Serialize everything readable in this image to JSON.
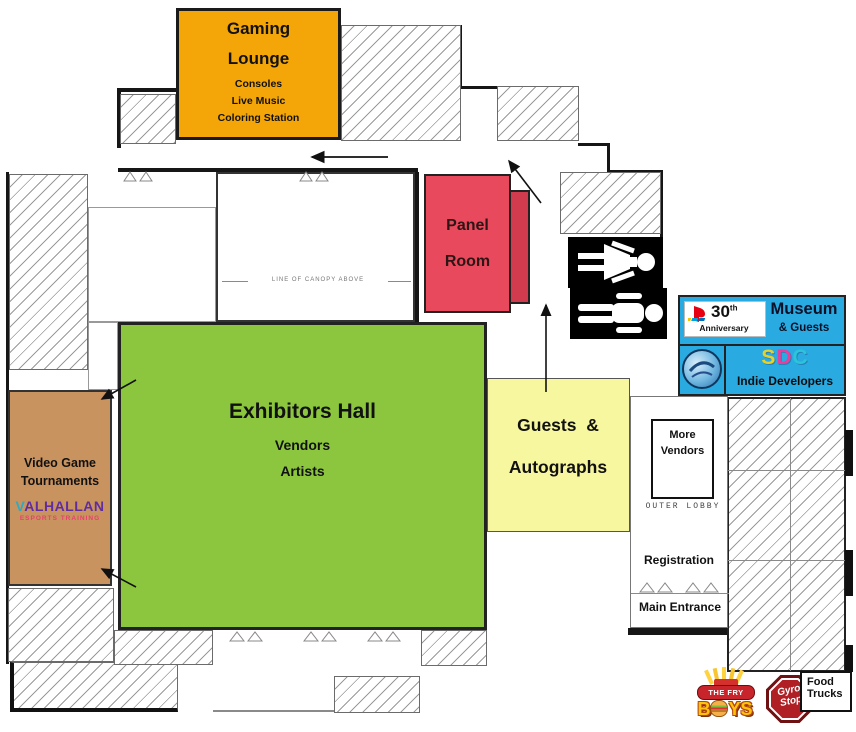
{
  "colors": {
    "gaming_lounge": "#F4A608",
    "panel_room": "#E8495C",
    "panel_room_shadow": "#D23B4E",
    "exhibitors_hall": "#8CC63E",
    "guests_autographs": "#F7F7A0",
    "video_game_tournaments": "#C9935F",
    "museum_blue": "#29ABE2",
    "restroom_black": "#000000"
  },
  "rooms": {
    "gaming_lounge": {
      "title_line1": "Gaming",
      "title_line2": "Lounge",
      "features": {
        "f1": "Consoles",
        "f2": "Live Music",
        "f3": "Coloring Station"
      }
    },
    "panel_room": {
      "line1": "Panel",
      "line2": "Room"
    },
    "exhibitors_hall": {
      "title": "Exhibitors Hall",
      "f1": "Vendors",
      "f2": "Artists"
    },
    "guests_autographs": {
      "line1": "Guests  &",
      "line2": "Autographs"
    },
    "video_game_tournaments": {
      "line1": "Video Game",
      "line2": "Tournaments"
    },
    "more_vendors": {
      "line1": "More",
      "line2": "Vendors"
    },
    "registration_label": "Registration",
    "main_entrance_label": "Main Entrance",
    "outer_lobby_label": "OUTER LOBBY",
    "canopy_note": "LINE OF CANOPY ABOVE"
  },
  "logos": {
    "valhallan": {
      "initial": "V",
      "rest": "ALHALLAN",
      "tagline": "ESPORTS TRAINING"
    },
    "playstation": {
      "number": "30",
      "ordinal": "th",
      "label": "Anniversary"
    },
    "museum": {
      "title": "Museum",
      "subtitle": "& Guests"
    },
    "sdc": {
      "s": "S",
      "d": "D",
      "c": "C",
      "label": "Indie Developers"
    },
    "fry_boys": {
      "banner": "THE FRY",
      "word_pre": "B",
      "word_post": "YS"
    },
    "gyro_stop": {
      "line1": "Gyro",
      "line2": "Stop"
    },
    "food_trucks": {
      "line1": "Food",
      "line2": "Trucks"
    }
  },
  "icons": {
    "restrooms_women": "women-restroom-icon",
    "restrooms_men": "men-restroom-icon",
    "playstation_mark": "playstation-logo-icon",
    "round_badge": "round-vg-badge-icon",
    "arrows": [
      "corridor-left-arrow",
      "panel-exit-arrow",
      "autographs-up-arrow",
      "tournaments-entry-arrow-top",
      "tournaments-entry-arrow-bottom"
    ]
  }
}
